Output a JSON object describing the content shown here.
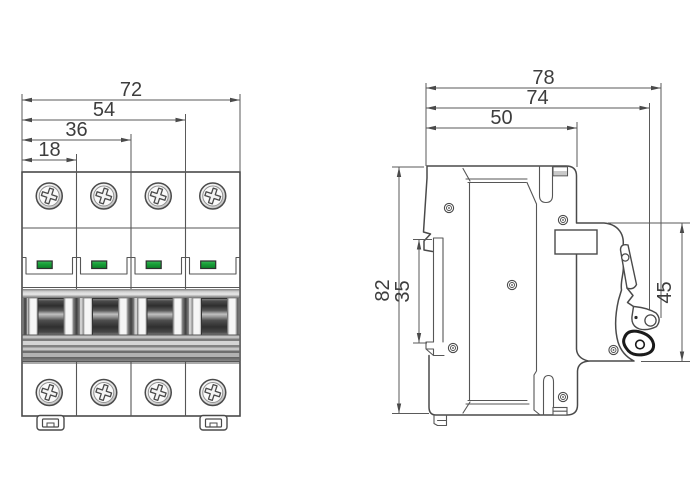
{
  "front": {
    "dims": [
      {
        "v": "72"
      },
      {
        "v": "54"
      },
      {
        "v": "36"
      },
      {
        "v": "18"
      }
    ]
  },
  "side": {
    "dims_top": [
      {
        "v": "78"
      },
      {
        "v": "74"
      },
      {
        "v": "50"
      }
    ],
    "dims_vertical": [
      {
        "v": "82"
      },
      {
        "v": "35"
      },
      {
        "v": "45"
      }
    ]
  },
  "colors": {
    "line": "#4a4a4a",
    "dimension_line": "#5a5a5a",
    "text": "#3d3d3d",
    "indicator_green": "#18a038",
    "handle_black": "#1a1a1a",
    "background": "#ffffff"
  }
}
